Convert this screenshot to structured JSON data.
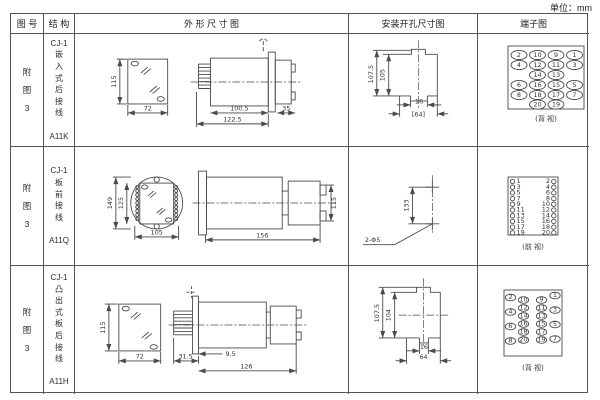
{
  "unit_label": "单位：mm",
  "header": {
    "fig": "图 号",
    "struct": "结 构",
    "outline": "外  形  尺  寸  图",
    "mount": "安装开孔尺寸图",
    "terminal": "端子图"
  },
  "rows": [
    {
      "fig_no": "附\n图\n3",
      "structure": "CJ-1\n嵌\n入\n式\n后\n接\n线\n\nA11K",
      "outline": {
        "front_h": "115",
        "front_w": "72",
        "d1": "100.5",
        "d2": "122.5",
        "d3": "35"
      },
      "mount": {
        "v_outer": "107.5",
        "v_inner": "105",
        "notch": "16",
        "width": "[64]"
      },
      "terminal": {
        "caption": "(背 视)",
        "grid": [
          [
            "2",
            "10",
            "9",
            "1"
          ],
          [
            "4",
            "12",
            "11",
            "3"
          ],
          [
            "",
            "14",
            "13",
            ""
          ],
          [
            "6",
            "16",
            "15",
            "5"
          ],
          [
            "8",
            "18",
            "17",
            "7"
          ],
          [
            "",
            "20",
            "19",
            ""
          ]
        ]
      }
    },
    {
      "fig_no": "附\n图\n3",
      "structure": "CJ-1\n板\n前\n接\n线\n\nA11Q",
      "outline": {
        "front_h_outer": "149",
        "front_h_inner": "125",
        "front_w": "105",
        "side_len": "156",
        "side_h": "115"
      },
      "mount": {
        "span": "133",
        "holes": "2-Φ5"
      },
      "terminal": {
        "caption": "(前 视)",
        "left": [
          "1",
          "3",
          "5",
          "7",
          "9",
          "11",
          "13",
          "15",
          "17",
          "19"
        ],
        "right": [
          "2",
          "4",
          "6",
          "8",
          "10",
          "12",
          "14",
          "16",
          "18",
          "20"
        ]
      }
    },
    {
      "fig_no": "附\n图\n3",
      "structure": "CJ-1\n凸\n出\n式\n板\n后\n接\n线\n\nA11H",
      "outline": {
        "front_h": "115",
        "front_w": "72",
        "d1": "31.5",
        "d2": "9.5",
        "d3": "126"
      },
      "mount": {
        "v_outer": "107.5",
        "v_inner": "104",
        "notch": "16",
        "width": "64"
      },
      "terminal": {
        "caption": "(背 视)",
        "outer_left": [
          "2",
          "4",
          "6",
          "8"
        ],
        "inner_left": [
          "10",
          "12",
          "14",
          "16",
          "18",
          "20"
        ],
        "inner_right": [
          "9",
          "11",
          "13",
          "15",
          "17",
          "19"
        ],
        "outer_right": [
          "1",
          "3",
          "5",
          "7"
        ]
      }
    }
  ]
}
